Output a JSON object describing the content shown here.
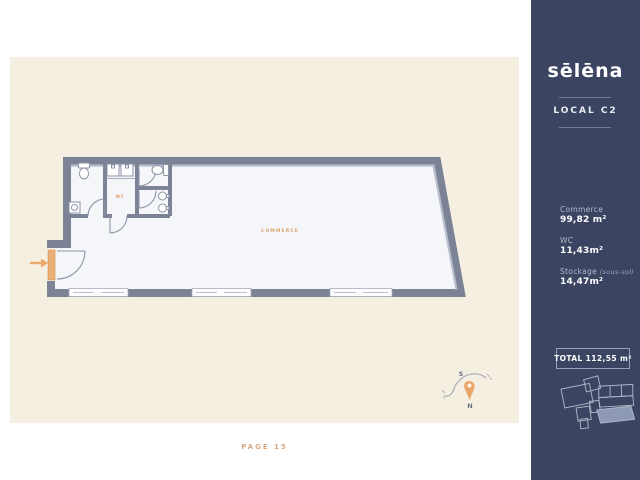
{
  "sidebar": {
    "logo": "sēlēna",
    "unit_label": "LOCAL C2",
    "stats": [
      {
        "label": "Commerce",
        "note": "",
        "value": "99,82 m²"
      },
      {
        "label": "WC",
        "note": "",
        "value": "11,43m²"
      },
      {
        "label": "Stockage",
        "note": "(sous-sol)",
        "value": "14,47m²"
      }
    ],
    "total_label": "TOTAL 112,55 m²"
  },
  "plan": {
    "commerce_label": "COMMERCE",
    "wc_label": "WC",
    "compass": {
      "south": "S",
      "north": "N",
      "west": "o",
      "east": "e"
    }
  },
  "footer": {
    "page_label": "PAGE 15"
  },
  "colors": {
    "sidebar_navy": "#3b4562",
    "paper_cream": "#f5efe2",
    "wall_dark": "#7c8397",
    "wall_light": "#b6bccb",
    "floor_fill": "#f5f6fa",
    "accent_orange": "#e9a869",
    "label_orange": "#dfa06a",
    "page_number": "#d9a783"
  }
}
